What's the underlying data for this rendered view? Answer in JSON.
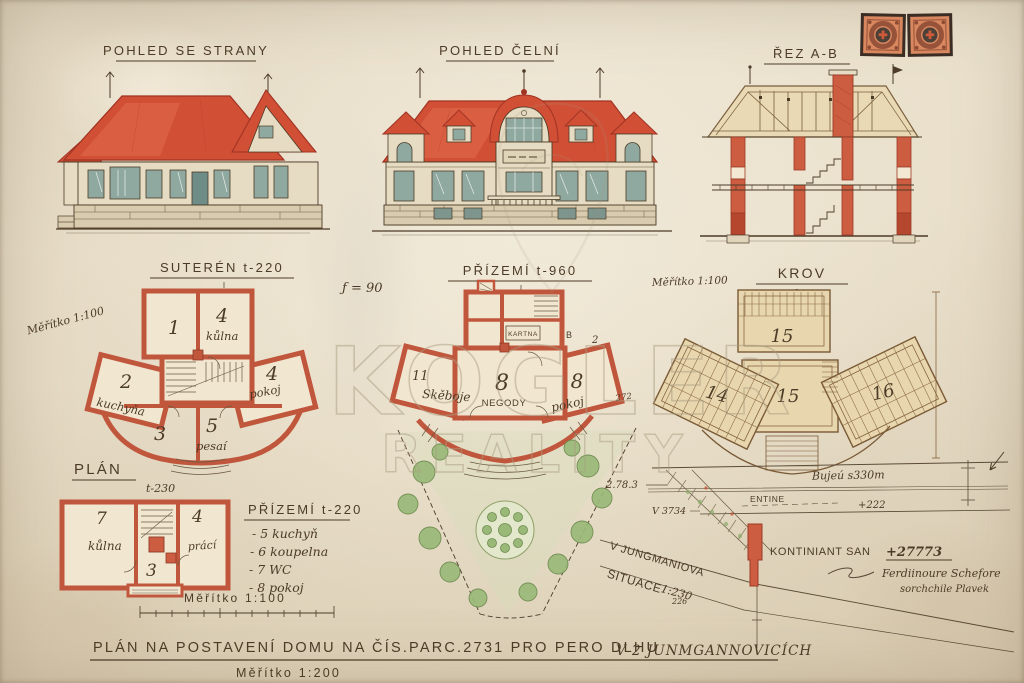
{
  "titles": {
    "side": "POHLED SE STRANY",
    "front": "POHLED ČELNÍ",
    "section": "ŘEZ A-B"
  },
  "suteren": {
    "title": "SUTERÉN t-220",
    "scale_diagonal": "Měřítko 1:100",
    "note": "ƒ = 90",
    "rooms": [
      {
        "num": "1",
        "label": ""
      },
      {
        "num": "4",
        "label": "kůlna"
      },
      {
        "num": "2",
        "label": "kuchyňa"
      },
      {
        "num": "4",
        "label": "pokoj"
      },
      {
        "num": "3",
        "label": ""
      },
      {
        "num": "5",
        "label": "pesaí"
      }
    ]
  },
  "prizemi": {
    "title": "PŘÍZEMÍ t-960",
    "tiny_label": "KARTNA",
    "ann_b": "B",
    "ann_2": "2",
    "ann_272": "272",
    "rooms": [
      {
        "num": "8",
        "label": "NEGODY"
      },
      {
        "num": "11",
        "label": "Skěboje"
      },
      {
        "num": "8",
        "label": "pokoj"
      }
    ]
  },
  "krov": {
    "title": "KROV",
    "subtitle": "2.t",
    "scale": "Měřítko 1:100",
    "rooms": [
      "15",
      "14",
      "15",
      "16"
    ]
  },
  "plan_small": {
    "title": "PLÁN",
    "height": "t-230",
    "rooms": [
      {
        "num": "7",
        "label": "kůlna"
      },
      {
        "num": "3",
        "label": ""
      },
      {
        "num": "4",
        "label": "prácí"
      }
    ]
  },
  "legend": {
    "title": "PŘÍZEMÍ t-220",
    "items": [
      "- 5 kuchyň",
      "- 6 koupelna",
      "- 7 WC",
      "- 8 pokoj"
    ],
    "scale": "Měřítko 1:100"
  },
  "site": {
    "situace": "SITUACE",
    "situace_scale": "1:230",
    "street": "V JUNGMANIOVA",
    "bench1": "2.78.3",
    "bench2": "V 3734",
    "bench3": "+222",
    "bench4": "226",
    "street_note": "Bujeú s330m",
    "line_label": "ENTINE",
    "kontiniant": "KONTINIANT SAN",
    "kontiniant_value": "+27773",
    "signature_line1": "Ferdiinoure Schefore",
    "signature_line2": "sorchchile Plavek"
  },
  "footer": {
    "title_main": "PLÁN NA POSTAVENÍ DOMU NA ČÍS.PARC.2731 PRO PERO DLHU",
    "title_suffix": "V 2 JUNMGANNOVICÍCH",
    "scale": "Měřítko 1:200"
  },
  "watermark": {
    "line1": "KOGLER",
    "line2": "REALITY"
  },
  "colors": {
    "paper": "#e9dfca",
    "ink": "#4c3b27",
    "roof_red": "#d14f35",
    "plan_wall_red": "#c0563c",
    "truss_tan": "#d8bc8a",
    "window_teal": "#8fa8a0",
    "garden_green": "#9ab978"
  }
}
